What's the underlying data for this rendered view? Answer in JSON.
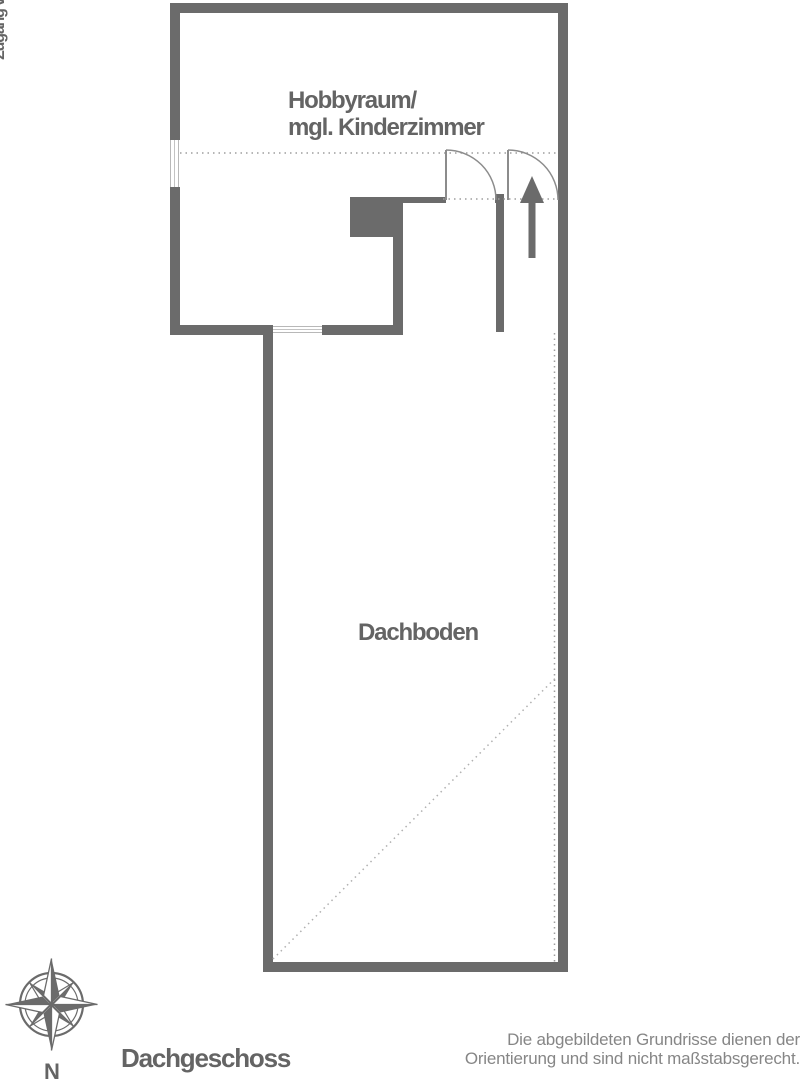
{
  "floor_plan": {
    "rooms": [
      {
        "id": "hobbyraum",
        "name_line1": "Hobbyraum/",
        "name_line2": "mgl. Kinderzimmer"
      },
      {
        "id": "dachboden",
        "name": "Dachboden"
      }
    ],
    "annotations": {
      "access_label": "Zugang vom 1.OG"
    }
  },
  "compass": {
    "label": "N"
  },
  "footer": {
    "floor_label": "Dachgeschoss",
    "disclaimer": {
      "line1": "Die abgebildeten Grundrisse dienen der",
      "line2": "Orientierung und sind nicht maßstabsgerecht."
    }
  },
  "colors": {
    "wall": "#6b6b6b",
    "label_text": "#646464",
    "dotted_line": "#9e9e9e",
    "window_line": "#b8b8b8",
    "disclaimer_text": "#868686",
    "background": "#ffffff"
  }
}
